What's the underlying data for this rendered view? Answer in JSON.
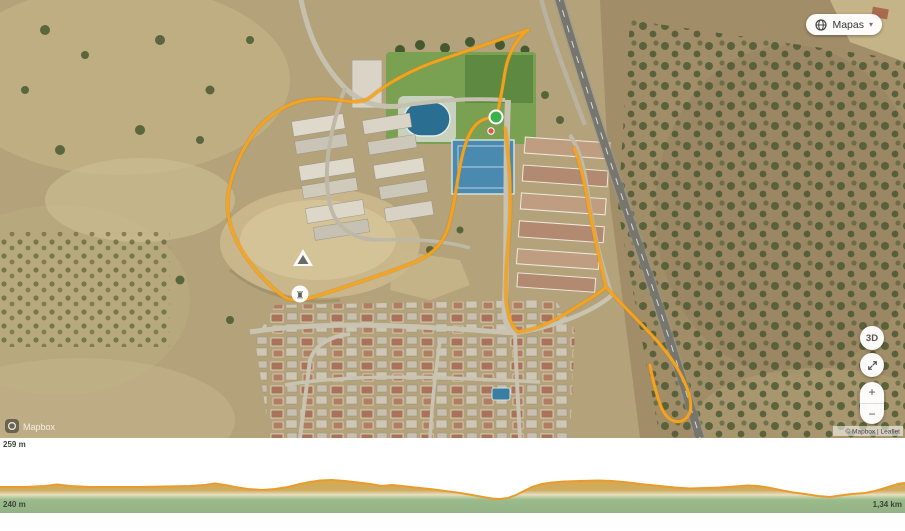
{
  "map": {
    "layers_button": {
      "label": "Mapas",
      "chevron": "▾"
    },
    "controls": {
      "three_d_label": "3D",
      "zoom_in": "+",
      "zoom_out": "−"
    },
    "watermark": "Mapbox",
    "attribution": "© Mapbox | Leaflet",
    "markers": {
      "ruin_glyph": "♜"
    }
  },
  "chart": {
    "max_altitude_label": "259 m",
    "min_altitude_label": "240 m",
    "total_distance_label": "1,34 km"
  },
  "chart_data": {
    "type": "area",
    "title": "Trail elevation profile",
    "x_label": "distance (km)",
    "y_label": "elevation (m)",
    "x_range_km": [
      0,
      1.34
    ],
    "y_min_m": 240,
    "y_max_m": 259,
    "distance_km": [
      0,
      0.07,
      0.08,
      0.13,
      0.21,
      0.28,
      0.32,
      0.35,
      0.39,
      0.43,
      0.46,
      0.49,
      0.53,
      0.57,
      0.6,
      0.64,
      0.68,
      0.72,
      0.74,
      0.76,
      0.79,
      0.82,
      0.86,
      0.89,
      0.93,
      0.98,
      1.02,
      1.07,
      1.11,
      1.14,
      1.17,
      1.21,
      1.23,
      1.26,
      1.3,
      1.32,
      1.34
    ],
    "elevation_m": [
      252,
      253,
      254,
      252,
      252,
      253,
      256,
      252,
      249,
      252,
      257,
      259,
      256,
      253,
      253,
      250,
      246,
      242,
      240,
      244,
      252,
      256,
      258,
      258,
      256,
      253,
      250,
      251,
      253,
      251,
      246,
      243,
      242,
      245,
      248,
      253,
      256
    ],
    "line_color": "#ea9b2d",
    "fill_colors": {
      "top": "#d8a94e",
      "pale": "#e7dfc0",
      "green": "#9cbb8d"
    },
    "legend": "none",
    "grid": false,
    "profile_px": [
      [
        0,
        49
      ],
      [
        25,
        49
      ],
      [
        45,
        48
      ],
      [
        57,
        46.5
      ],
      [
        70,
        48
      ],
      [
        90,
        49
      ],
      [
        115,
        49
      ],
      [
        140,
        49
      ],
      [
        165,
        48.5
      ],
      [
        190,
        48
      ],
      [
        205,
        47
      ],
      [
        215,
        45.5
      ],
      [
        225,
        47
      ],
      [
        235,
        49
      ],
      [
        248,
        51
      ],
      [
        262,
        52
      ],
      [
        275,
        51
      ],
      [
        288,
        49
      ],
      [
        300,
        46
      ],
      [
        310,
        44
      ],
      [
        320,
        42.5
      ],
      [
        332,
        42
      ],
      [
        345,
        43
      ],
      [
        358,
        44.5
      ],
      [
        370,
        46
      ],
      [
        382,
        48
      ],
      [
        392,
        47
      ],
      [
        402,
        48
      ],
      [
        415,
        49.5
      ],
      [
        430,
        51
      ],
      [
        445,
        53
      ],
      [
        460,
        55
      ],
      [
        472,
        57
      ],
      [
        483,
        59
      ],
      [
        492,
        60.5
      ],
      [
        500,
        61
      ],
      [
        508,
        60
      ],
      [
        516,
        57
      ],
      [
        524,
        53
      ],
      [
        532,
        49
      ],
      [
        542,
        46
      ],
      [
        552,
        44.5
      ],
      [
        565,
        43.5
      ],
      [
        580,
        43
      ],
      [
        598,
        42.5
      ],
      [
        612,
        43
      ],
      [
        628,
        44.5
      ],
      [
        645,
        46.5
      ],
      [
        660,
        48
      ],
      [
        675,
        49.5
      ],
      [
        690,
        50.5
      ],
      [
        705,
        50
      ],
      [
        720,
        49.5
      ],
      [
        735,
        48.5
      ],
      [
        748,
        47.5
      ],
      [
        758,
        48
      ],
      [
        768,
        49.5
      ],
      [
        780,
        52
      ],
      [
        793,
        54.5
      ],
      [
        805,
        56
      ],
      [
        818,
        58
      ],
      [
        830,
        59
      ],
      [
        840,
        57.5
      ],
      [
        852,
        56
      ],
      [
        865,
        55
      ],
      [
        875,
        53
      ],
      [
        885,
        50
      ],
      [
        893,
        47.5
      ],
      [
        900,
        45.5
      ],
      [
        905,
        45
      ]
    ]
  }
}
